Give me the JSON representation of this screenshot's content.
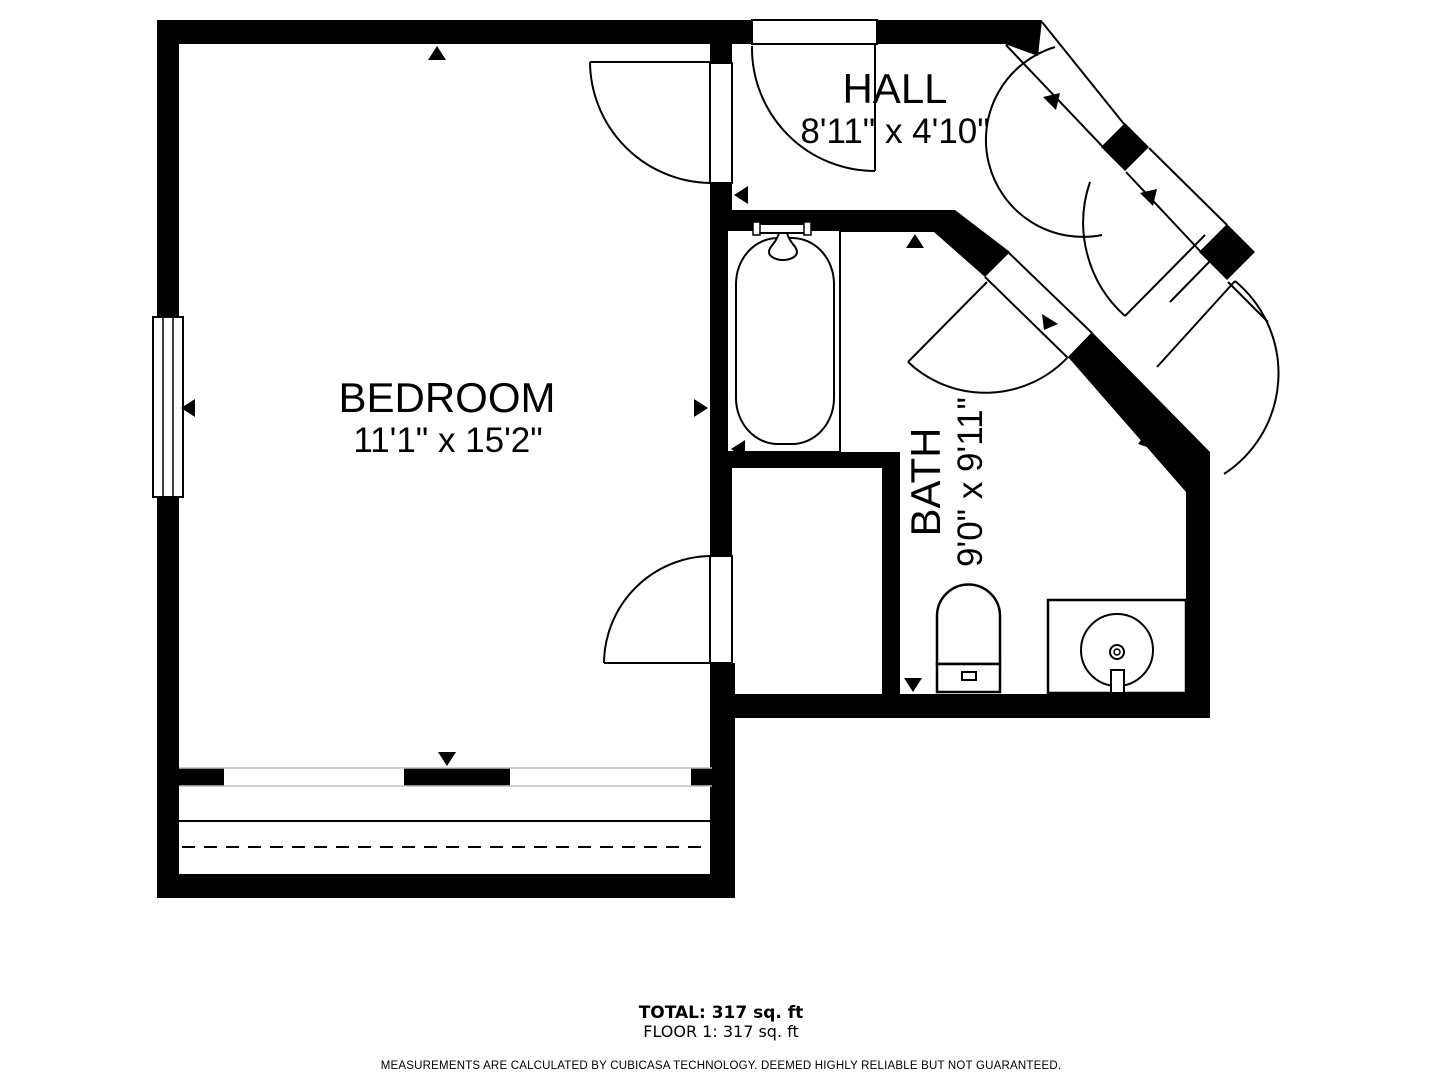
{
  "colors": {
    "ink": "#000000",
    "background": "#ffffff",
    "faint_line": "#bdbdbd"
  },
  "rooms": [
    {
      "name": "BEDROOM",
      "dimensions": "11'1\" x 15'2\""
    },
    {
      "name": "HALL",
      "dimensions": "8'11\" x 4'10\""
    },
    {
      "name": "BATH",
      "dimensions": "9'0\" x 9'11\""
    }
  ],
  "summary": {
    "total": "TOTAL: 317 sq. ft",
    "floor": "FLOOR 1: 317 sq. ft",
    "disclaimer": "MEASUREMENTS ARE CALCULATED BY CUBICASA TECHNOLOGY. DEEMED HIGHLY RELIABLE BUT NOT GUARANTEED."
  }
}
